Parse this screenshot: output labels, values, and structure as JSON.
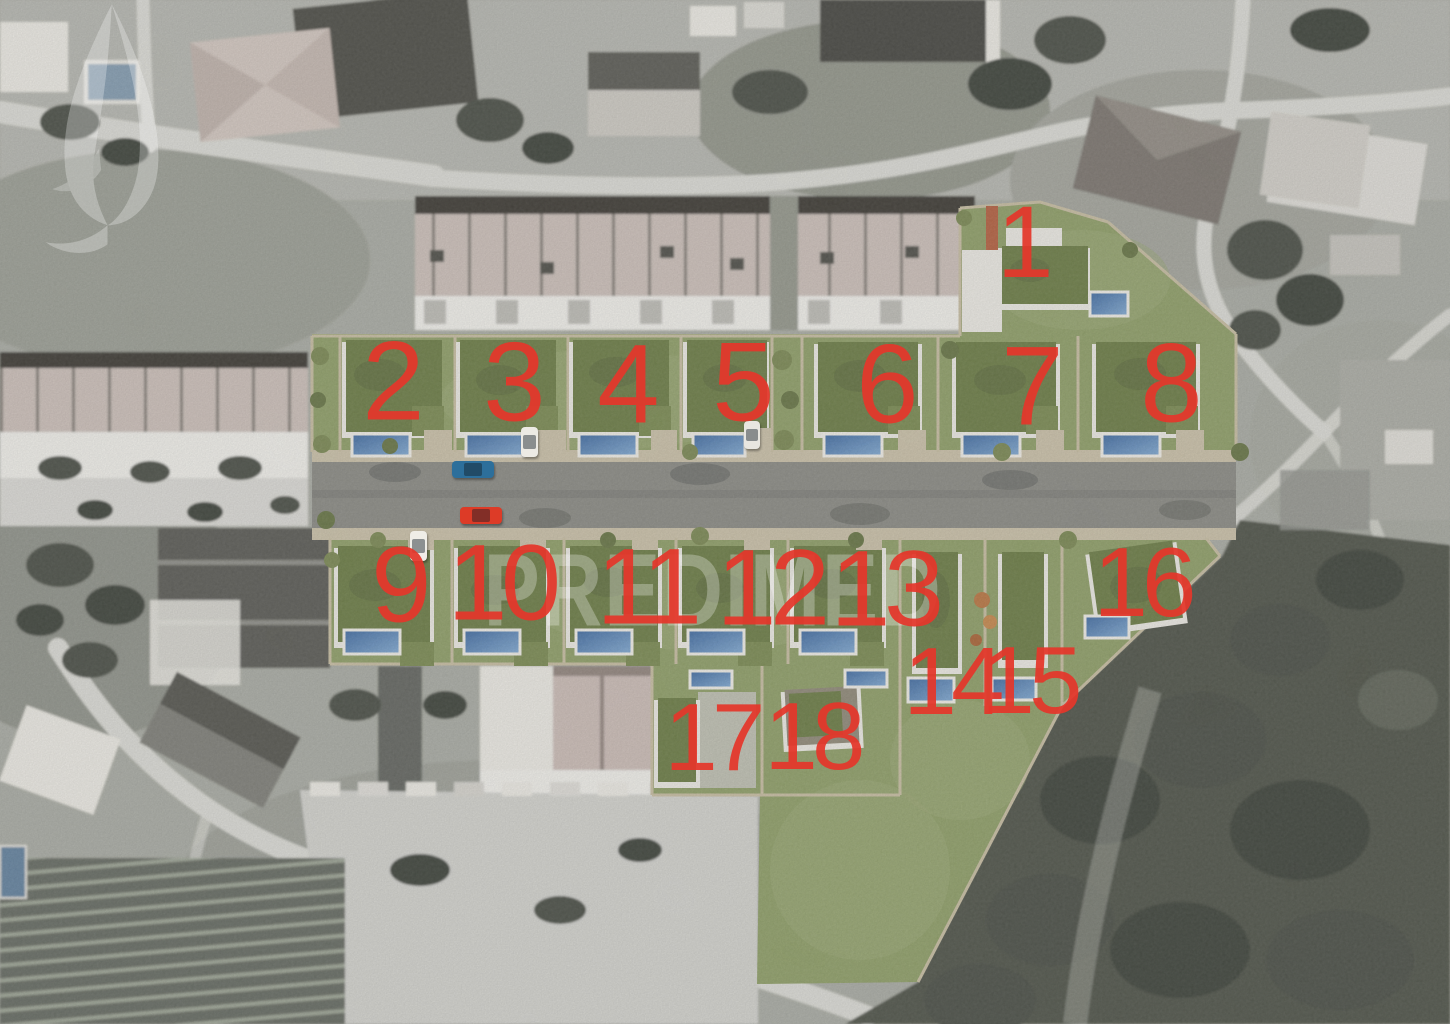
{
  "watermark": {
    "text": "PREDIMED",
    "icon": "leaf-watermark"
  },
  "lot_numbers": {
    "description_color": "#e5372b",
    "items": [
      {
        "label": "1",
        "x": 1022,
        "y": 246,
        "size": 102
      },
      {
        "label": "2",
        "x": 390,
        "y": 386,
        "size": 112
      },
      {
        "label": "3",
        "x": 511,
        "y": 387,
        "size": 112
      },
      {
        "label": "4",
        "x": 625,
        "y": 389,
        "size": 112
      },
      {
        "label": "5",
        "x": 740,
        "y": 387,
        "size": 112
      },
      {
        "label": "6",
        "x": 884,
        "y": 389,
        "size": 112
      },
      {
        "label": "7",
        "x": 1029,
        "y": 391,
        "size": 112
      },
      {
        "label": "8",
        "x": 1168,
        "y": 388,
        "size": 112
      },
      {
        "label": "9",
        "x": 398,
        "y": 589,
        "size": 108
      },
      {
        "label": "10",
        "x": 501,
        "y": 587,
        "size": 108
      },
      {
        "label": "11",
        "x": 646,
        "y": 591,
        "size": 108
      },
      {
        "label": "12",
        "x": 770,
        "y": 592,
        "size": 108
      },
      {
        "label": "13",
        "x": 884,
        "y": 593,
        "size": 108
      },
      {
        "label": "14",
        "x": 951,
        "y": 686,
        "size": 96
      },
      {
        "label": "15",
        "x": 1029,
        "y": 685,
        "size": 96
      },
      {
        "label": "16",
        "x": 1142,
        "y": 586,
        "size": 98
      },
      {
        "label": "17",
        "x": 712,
        "y": 742,
        "size": 96
      },
      {
        "label": "18",
        "x": 812,
        "y": 741,
        "size": 96
      }
    ]
  },
  "vehicles": [
    {
      "name": "blue-car",
      "color": "#2d6f9b",
      "x": 452,
      "y": 461,
      "w": 42,
      "h": 17
    },
    {
      "name": "red-car",
      "color": "#dd3b27",
      "x": 460,
      "y": 507,
      "w": 42,
      "h": 17
    },
    {
      "name": "white-car-driveway-a",
      "color": "#eceae4",
      "x": 521,
      "y": 427,
      "w": 17,
      "h": 30
    },
    {
      "name": "white-car-driveway-b",
      "color": "#e8e6e0",
      "x": 744,
      "y": 421,
      "w": 16,
      "h": 28
    },
    {
      "name": "white-car-driveway-c",
      "color": "#efede7",
      "x": 410,
      "y": 531,
      "w": 17,
      "h": 30
    }
  ],
  "palette": {
    "numred": "#e5372b",
    "wmfill": "#ffffff",
    "wmopacity": "0.28",
    "bg": "#a5a79f",
    "roadlight": "#d8d8d2",
    "lawn": "#8a9a62",
    "lawn2": "#96a46f",
    "groof": "#66773f",
    "groof2": "#75864c",
    "bldwhite": "#e9e7e0",
    "deck": "#eceae3",
    "wall": "#c3b99d",
    "nroad": "#85857f",
    "sidewalk": "#c6bda4",
    "tree": "#454a40",
    "forest": "#484d42",
    "ctree": "#75834d",
    "orange": "#b5713c",
    "roofpale": "#c8bcb5",
    "roofdark": "#38362f",
    "pool_dark": "#3a659c",
    "pool_light": "#7da6cf"
  }
}
